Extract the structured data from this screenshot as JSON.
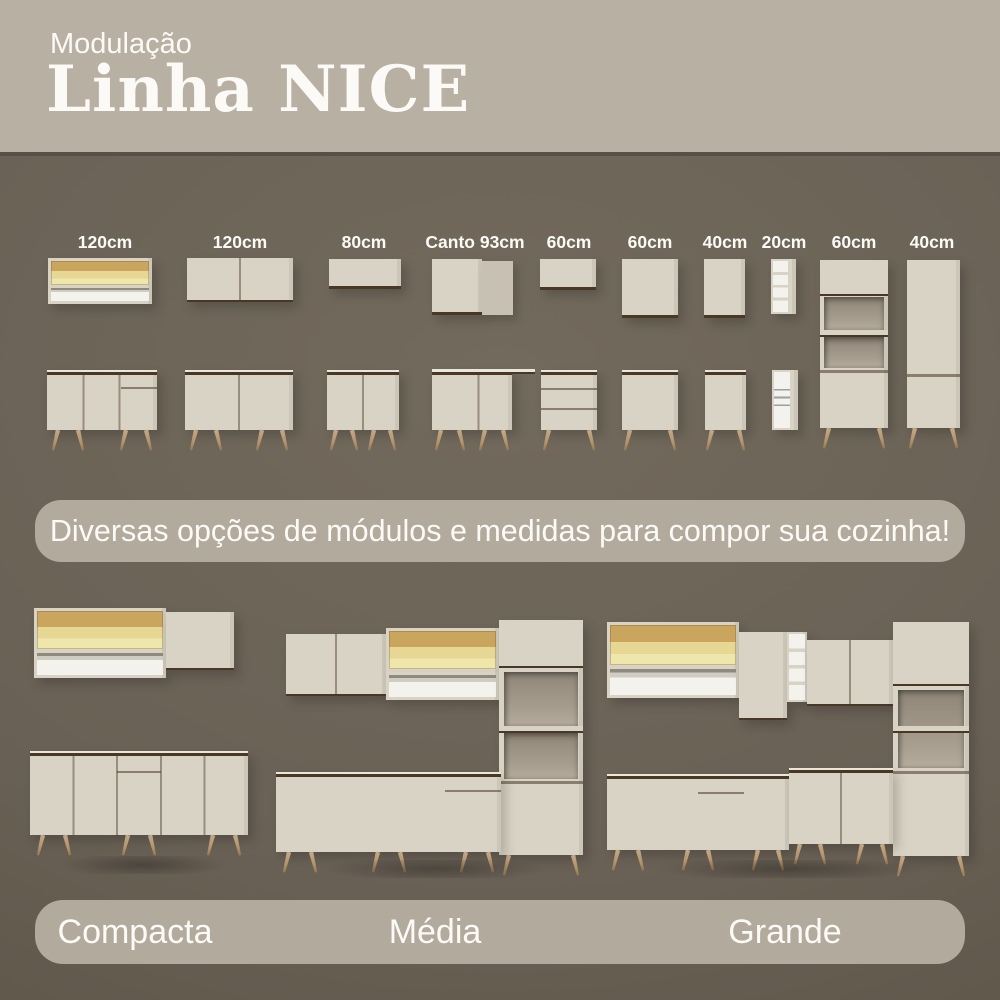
{
  "header": {
    "subtitle": "Modulação",
    "title": "Linha NICE"
  },
  "modules": {
    "items": [
      {
        "label": "120cm",
        "top_module": "wall-cabinet-glass-doors-with-open-shelf",
        "bottom_module": "base-cabinet-3-doors-1-drawer"
      },
      {
        "label": "120cm",
        "top_module": "wall-cabinet-2-doors",
        "bottom_module": "base-cabinet-2-doors"
      },
      {
        "label": "80cm",
        "top_module": "wall-flap-cabinet",
        "bottom_module": "base-cabinet-2-doors"
      },
      {
        "label": "Canto 93cm",
        "top_module": "corner-wall-cabinet",
        "bottom_module": "corner-base-cabinet"
      },
      {
        "label": "60cm",
        "top_module": "wall-flap-cabinet",
        "bottom_module": "base-drawer-unit-3-drawers"
      },
      {
        "label": "60cm",
        "top_module": "wall-cabinet-1-door",
        "bottom_module": "base-cabinet-1-door"
      },
      {
        "label": "40cm",
        "top_module": "wall-cabinet-1-door",
        "bottom_module": "base-cabinet-1-door"
      },
      {
        "label": "20cm",
        "top_module": "open-shelf-unit",
        "bottom_module": "bottle-rack-unit"
      },
      {
        "label": "60cm",
        "tower_module": "oven-tower-with-niches"
      },
      {
        "label": "40cm",
        "tower_module": "tall-cabinet-2-doors"
      }
    ]
  },
  "banner": {
    "text": "Diversas opções de módulos e medidas para compor sua cozinha!"
  },
  "kitchen_sizes": [
    {
      "label": "Compacta"
    },
    {
      "label": "Média"
    },
    {
      "label": "Grande"
    }
  ],
  "colors": {
    "background": "#6a6156",
    "header_background": "#b8b0a2",
    "banner_background": "#b2aa9c",
    "cabinet_front": "#d9d3c5",
    "cabinet_side": "#c8c1b3",
    "wood_trim": "#4a3827",
    "counter_top": "#ebe6da",
    "glass_amber": "#e7d795",
    "glass_wood": "#c9a55d",
    "niche_interior": "#8d8476",
    "open_interior": "#f4f2ec",
    "leg_wood": "#b2946f",
    "text": "#fbfaf6"
  }
}
